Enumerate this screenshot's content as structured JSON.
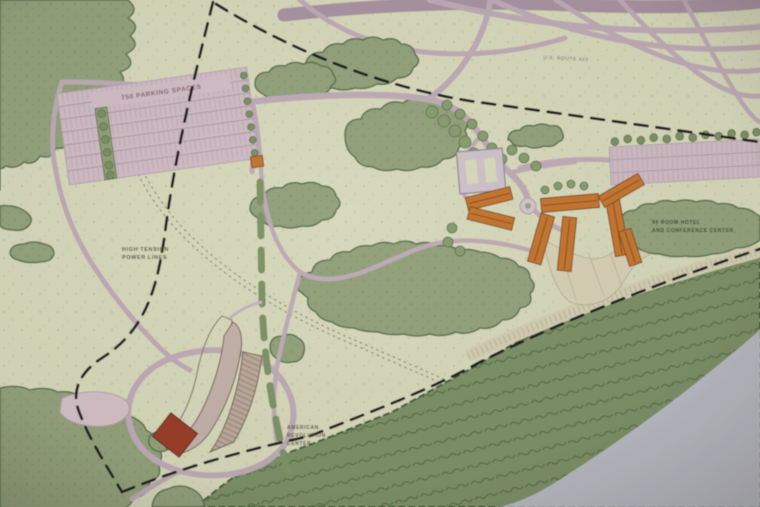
{
  "image_type": "photograph of a printed landscape-architecture site master plan",
  "labels": {
    "route": "U.S. ROUTE 422",
    "parking": "750 PARKING SPACES",
    "power_line_1": "HIGH TENSION",
    "power_line_2": "POWER LINES",
    "hotel_line_1": "99 ROOM HOTEL",
    "hotel_line_2": "AND CONFERENCE CENTER",
    "center_line_1": "AMERICAN",
    "center_line_2": "REVOLUTION",
    "center_line_3": "CENTER"
  },
  "colors": {
    "field": "#dcdfc0",
    "stipple": "#b4b892",
    "road": "#c2afbb",
    "road_major": "#ab96a6",
    "parking": "#d4c1ca",
    "tree": "#95a67e",
    "tree_edge": "#5a7350",
    "forest_band": "#7d9367",
    "forest_edge": "#445f3b",
    "river": "#b9bfc8",
    "building_orange": "#c8772f",
    "building_orange_edge": "#7d431c",
    "museum_red": "#9c3a28",
    "boundary_dash": "#1e1e1e",
    "rail_corridor": "#d8d4b7"
  },
  "features": [
    "highway interchange ramps (top)",
    "west surface parking lot with planted medians",
    "east parking lot with tree row",
    "courtyard building with light roof",
    "orange hotel / conference building cluster with radiating courtyards",
    "museum building with curved roof forms and red block",
    "entry drive and internal paths",
    "loop road with drop-off plaza",
    "high-tension power line (double dotted line)",
    "rail corridor band",
    "black dashed site boundary",
    "woodland tree masses",
    "riparian forest band",
    "river (bottom right)"
  ]
}
